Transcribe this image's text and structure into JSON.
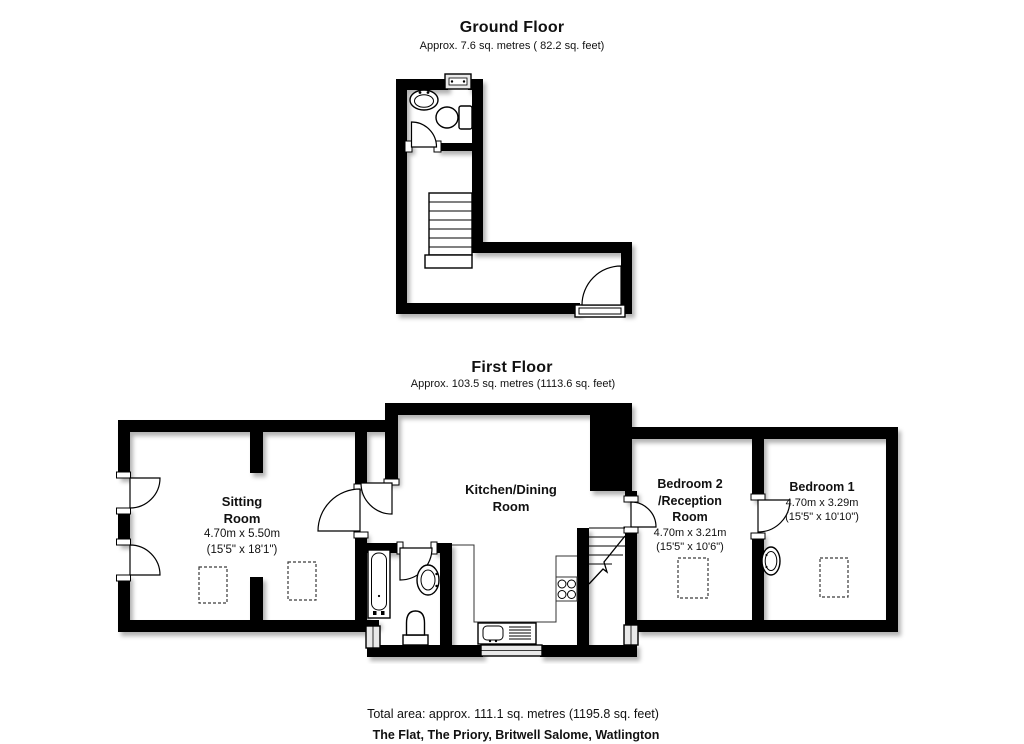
{
  "ground_floor": {
    "title": "Ground Floor",
    "subtitle": "Approx. 7.6 sq. metres ( 82.2 sq. feet)"
  },
  "first_floor": {
    "title": "First Floor",
    "subtitle": "Approx. 103.5 sq. metres (1113.6 sq. feet)",
    "rooms": {
      "sitting": {
        "line1": "Sitting",
        "line2": "Room",
        "metric": "4.70m x 5.50m",
        "imperial": "(15'5\" x 18'1\")"
      },
      "kitchen": {
        "line1": "Kitchen/Dining",
        "line2": "Room"
      },
      "bedroom2": {
        "line1": "Bedroom 2",
        "line2": "/Reception",
        "line3": "Room",
        "metric": "4.70m x 3.21m",
        "imperial": "(15'5\" x 10'6\")"
      },
      "bedroom1": {
        "line1": "Bedroom 1",
        "metric": "4.70m x 3.29m",
        "imperial": "(15'5\" x 10'10\")"
      }
    }
  },
  "footer": {
    "total_area": "Total area: approx. 111.1 sq. metres (1195.8 sq. feet)",
    "address": "The Flat, The Priory, Britwell Salome, Watlington"
  },
  "colors": {
    "wall": "#000000",
    "floor": "#ffffff",
    "text": "#111111"
  }
}
